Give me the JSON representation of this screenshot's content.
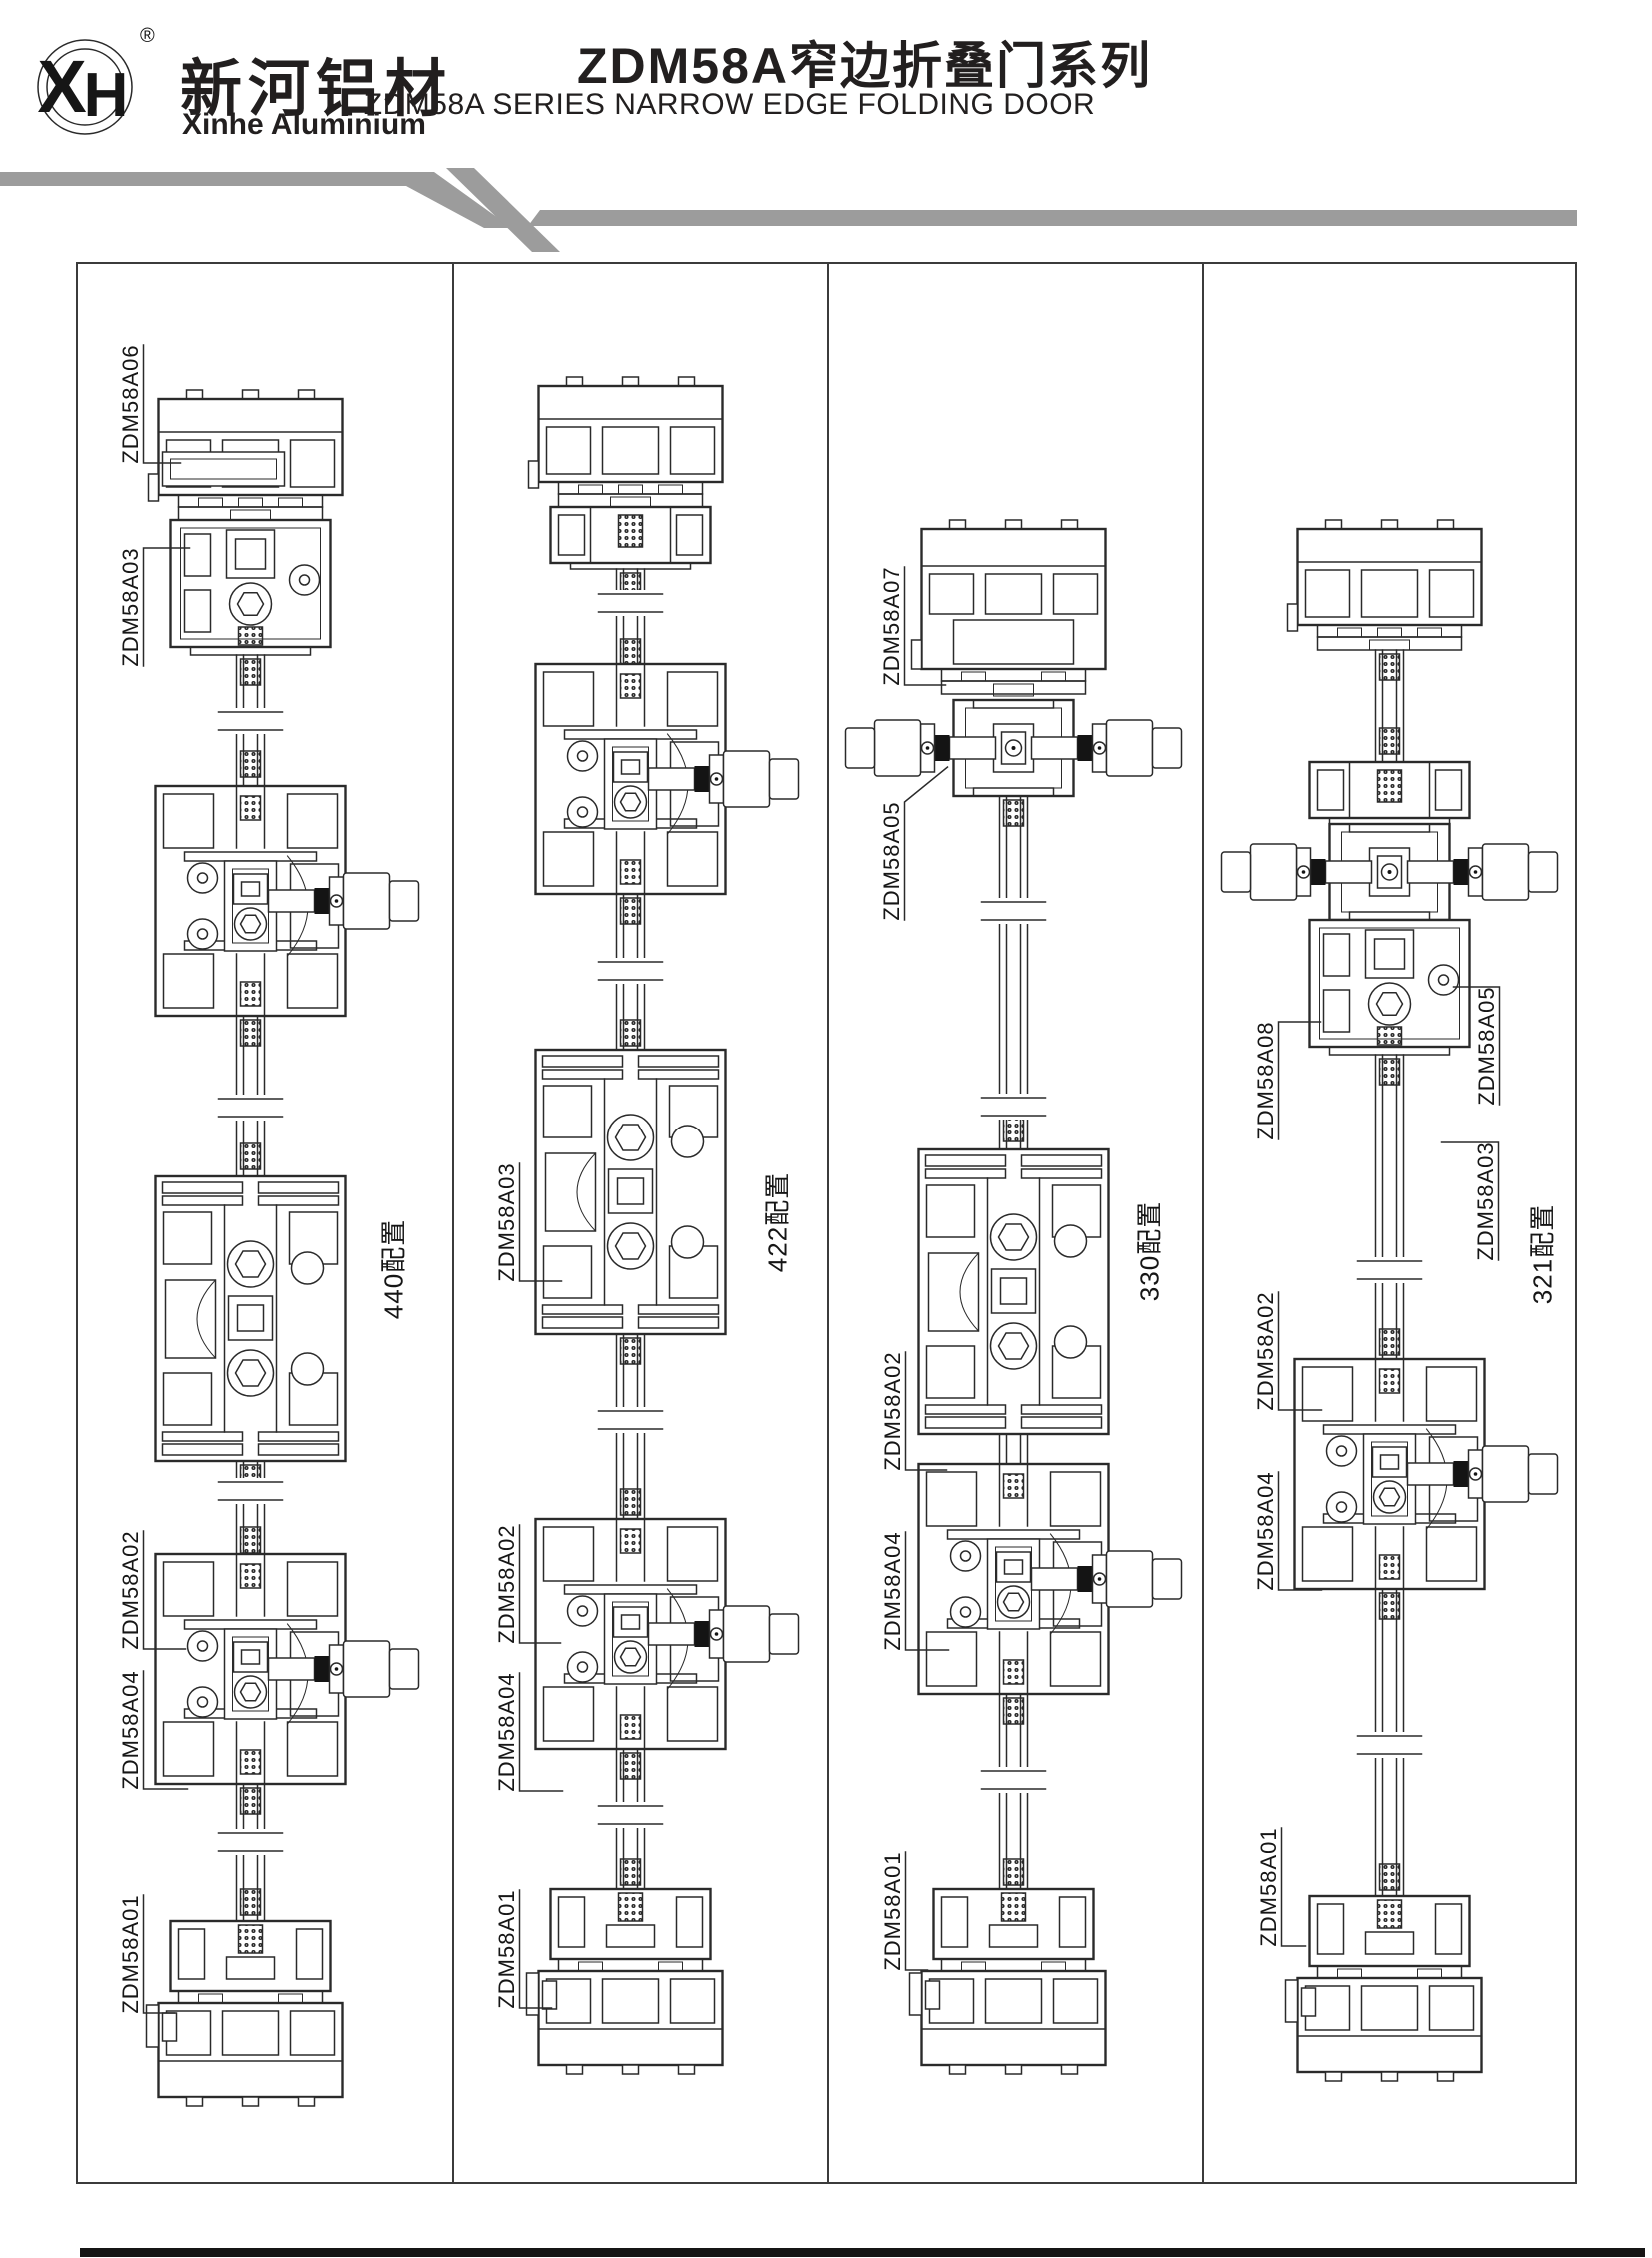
{
  "header": {
    "logo_xh": "XH",
    "logo_registered": "®",
    "brand_cn": "新河铝材",
    "brand_en": "Xinhe Aluminium",
    "title_cn": "ZDM58A窄边折叠门系列",
    "title_en": "ZDM58A SERIES NARROW EDGE FOLDING DOOR"
  },
  "colors": {
    "ink": "#2a2a2a",
    "stripe_gray": "#9c9c9c",
    "footer_black": "#151515"
  },
  "columns": [
    {
      "config": "440配置",
      "parts": [
        "ZDM58A06",
        "ZDM58A03",
        "ZDM58A02",
        "ZDM58A04",
        "ZDM58A01"
      ]
    },
    {
      "config": "422配置",
      "parts": [
        "ZDM58A03",
        "ZDM58A02",
        "ZDM58A04",
        "ZDM58A01"
      ]
    },
    {
      "config": "330配置",
      "parts": [
        "ZDM58A07",
        "ZDM58A05",
        "ZDM58A02",
        "ZDM58A04",
        "ZDM58A01"
      ]
    },
    {
      "config": "321配置",
      "parts": [
        "ZDM58A08",
        "ZDM58A05",
        "ZDM58A03",
        "ZDM58A02",
        "ZDM58A04",
        "ZDM58A01"
      ]
    }
  ]
}
